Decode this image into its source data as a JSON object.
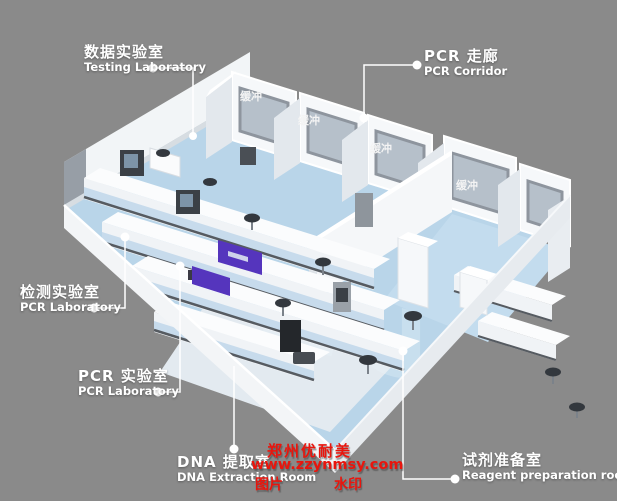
{
  "scene": {
    "description": "isometric-3d-render-of-pcr-laboratory-floor-plan",
    "background_color": "#8a8a8a",
    "floor_color": "#b9d5e9",
    "wall_color": "#f4f6f8",
    "accent_purple": "#5535bd",
    "window_glass_color": "#b6c0ca",
    "stool_color": "#33383e",
    "label_color": "#ffffff",
    "watermark_red": "#e9150d"
  },
  "callouts": [
    {
      "zh": "数据实验室",
      "en": "Testing Laboratory"
    },
    {
      "zh": "PCR 走廊",
      "en": "PCR Corridor"
    },
    {
      "zh": "检测实验室",
      "en": "PCR Laboratory"
    },
    {
      "zh": "PCR 实验室",
      "en": "PCR Laboratory"
    },
    {
      "zh": "DNA 提取室",
      "en": "DNA Extraction Room"
    },
    {
      "zh": "试剂准备室",
      "en": "Reagent preparation room"
    }
  ],
  "buffers": [
    "缓冲",
    "缓冲",
    "缓冲",
    "缓冲"
  ],
  "floor_watermark": "WU",
  "watermark": {
    "company": "郑州优耐美",
    "url": "www.zzynmsy.com",
    "tag_left": "图片",
    "tag_right": "水印"
  }
}
